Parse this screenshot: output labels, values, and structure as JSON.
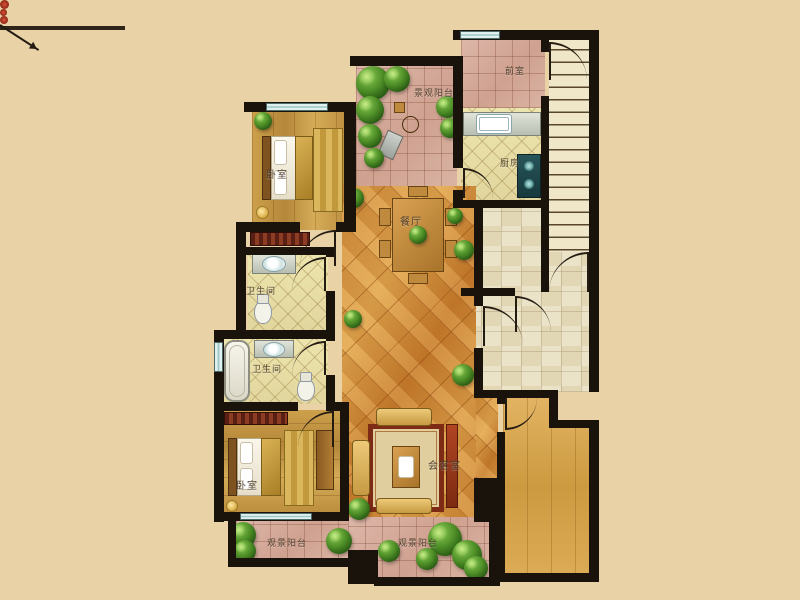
{
  "app": {
    "type": "residential-floor-plan"
  },
  "palette": {
    "background": "#e8d2a6",
    "wall": "#1a130c",
    "balcony_tile": "#d9b3a3",
    "bath_kitchen_tile": "#eae2ad",
    "hall_tile": "#e9e0c2",
    "main_floor_orange": "#d59240",
    "wood_floor": "#c89a44",
    "plant_green": "#4e8f27",
    "window_glass": "#c9e4e4"
  },
  "rooms": [
    {
      "id": "bedroom-top",
      "label": "卧室"
    },
    {
      "id": "balcony-top",
      "label": "景观阳台"
    },
    {
      "id": "front-room",
      "label": "前室"
    },
    {
      "id": "kitchen",
      "label": "厨房"
    },
    {
      "id": "dining-room",
      "label": "餐厅"
    },
    {
      "id": "bathroom-upper",
      "label": "卫生间"
    },
    {
      "id": "bathroom-lower",
      "label": "卫生间"
    },
    {
      "id": "bedroom-bottom",
      "label": "卧室"
    },
    {
      "id": "living-room",
      "label": "会客室"
    },
    {
      "id": "balcony-bottom-left",
      "label": "观景阳台"
    },
    {
      "id": "balcony-bottom-right",
      "label": "观景阳台"
    }
  ]
}
